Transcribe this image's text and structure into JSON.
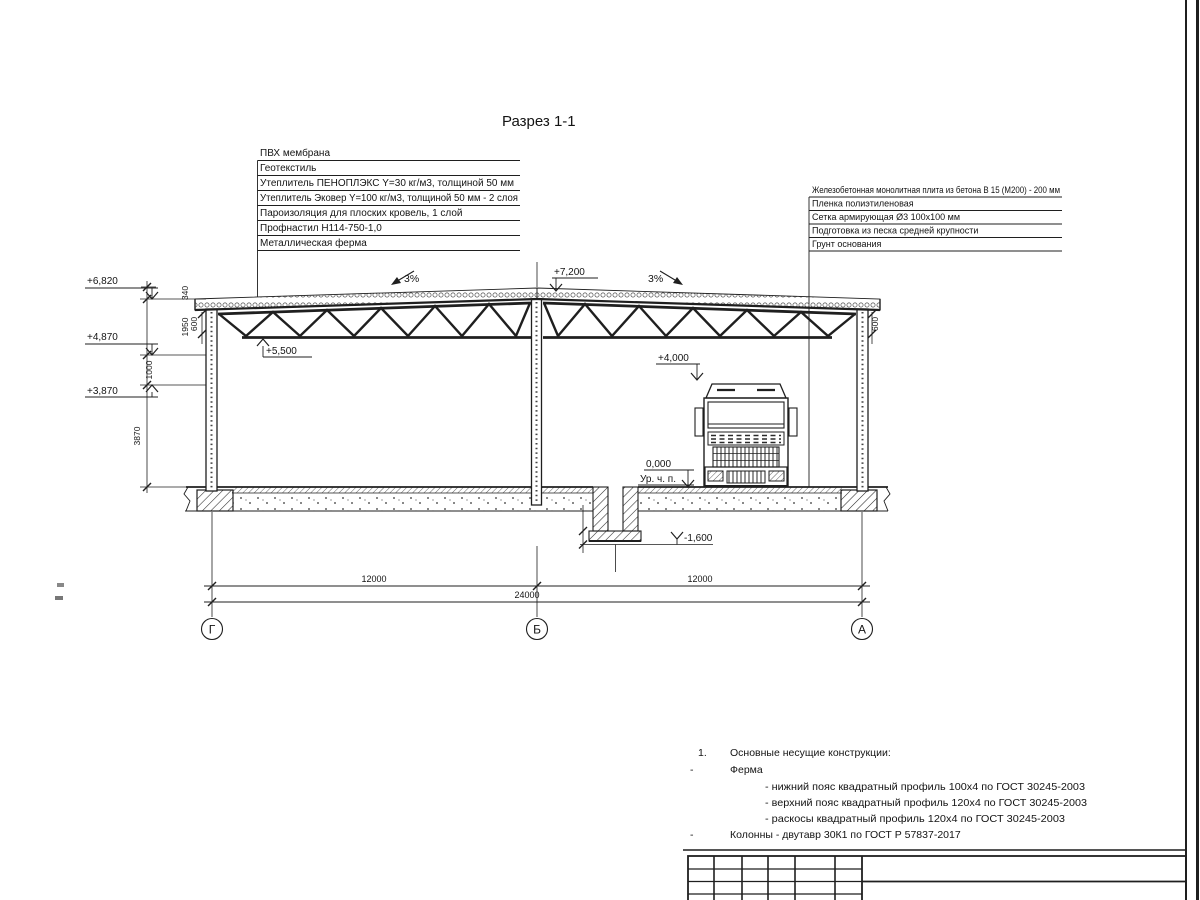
{
  "sheet": {
    "title": "Разрез 1-1"
  },
  "roof_callouts": [
    "ПВХ мембрана",
    "Геотекстиль",
    "Утеплитель ПЕНОПЛЭКС Y=30 кг/м3, толщиной 50 мм",
    "Утеплитель Эковер Y=100 кг/м3, толщиной 50 мм - 2 слоя",
    "Пароизоляция для плоских кровель, 1 слой",
    "Профнастил  Н114-750-1,0",
    "Металлическая ферма"
  ],
  "floor_callouts": [
    "Железобетонная монолитная плита из бетона В 15 (М200) - 200 мм",
    "Пленка полиэтиленовая",
    "Сетка армирующая Ø3 100х100 мм",
    "Подготовка из песка средней крупности",
    "Грунт основания"
  ],
  "elevations": {
    "ridge": "+7,200",
    "eaves": "+6,820",
    "truss_support": "+4,870",
    "wall_panel": "+3,870",
    "bottom_chord": "+5,500",
    "clearance": "+4,000",
    "floor": "0,000",
    "floor_caption": "Ур. ч. п.",
    "pit_bottom": "-1,600"
  },
  "slopes": {
    "left": "3%",
    "right": "3%"
  },
  "dimensions": {
    "vertical": {
      "parapet": "340",
      "truss_zone": "1950",
      "panel_zone": "1000",
      "wall_height": "3870"
    },
    "eaves_offset_left": "600",
    "eaves_offset_right": "600",
    "span_left": "12000",
    "span_right": "12000",
    "total": "24000"
  },
  "axes": {
    "left": "Г",
    "middle": "Б",
    "right": "А"
  },
  "notes": {
    "item_number": "1.",
    "heading": "Основные несущие конструкции:",
    "dash": "-",
    "truss_label": "Ферма",
    "truss_details": [
      "- нижний пояс квадратный профиль 100х4 по ГОСТ 30245-2003",
      "- верхний пояс квадратный профиль 120х4 по ГОСТ 30245-2003",
      "- раскосы квадратный профиль 120х4 по ГОСТ 30245-2003"
    ],
    "columns_label": "Колонны - двутавр 30К1 по ГОСТ Р 57837-2017"
  }
}
